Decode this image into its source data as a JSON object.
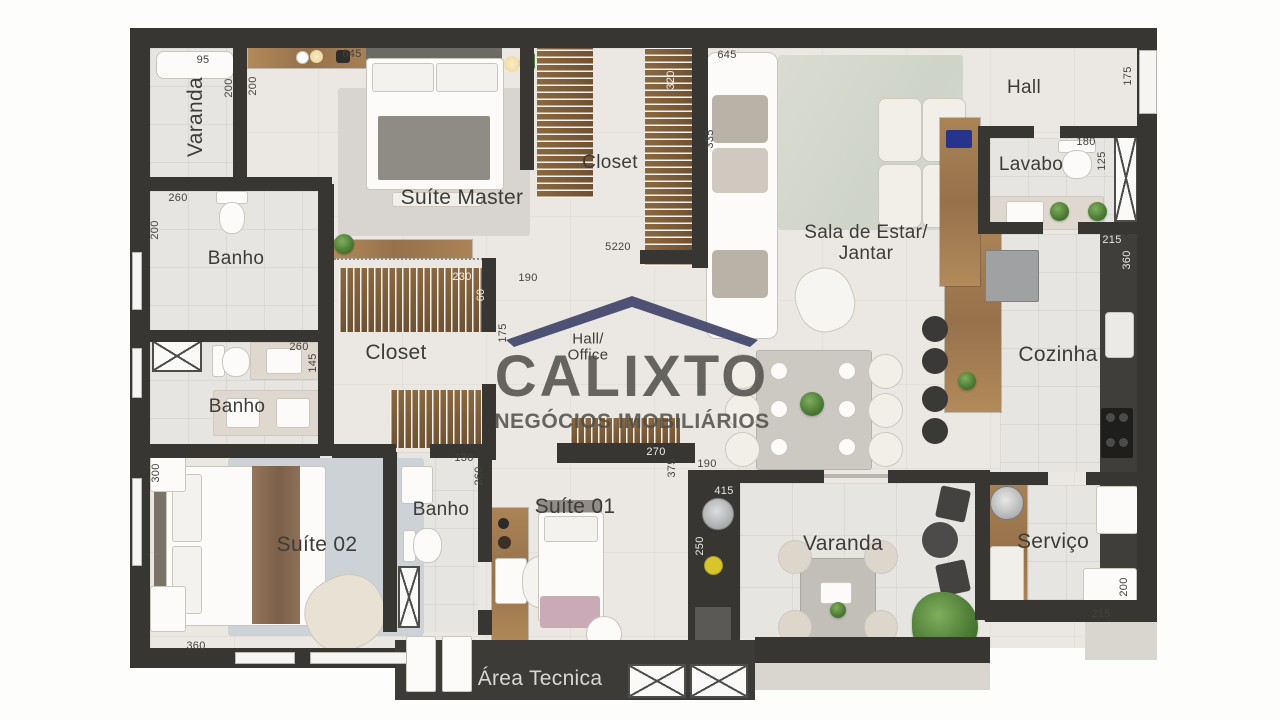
{
  "watermark": {
    "brand": "CALIXTO",
    "tagline": "NEGÓCIOS IMOBILIÁRIOS",
    "roof_color": "#3d4066",
    "text_color": "#4e4c46"
  },
  "colors": {
    "wall": "#383633",
    "floor": "#ebe8e3",
    "wood": "#a07a4e"
  },
  "rooms": {
    "varanda_top": "Varanda",
    "suite_master": "Suíte Master",
    "closet_top": "Closet",
    "hall": "Hall",
    "lavabo": "Lavabo",
    "sala_line1": "Sala de Estar/",
    "sala_line2": "Jantar",
    "banho_upper": "Banho",
    "banho_lower": "Banho",
    "closet_mid": "Closet",
    "hall_office_line1": "Hall/",
    "hall_office_line2": "Office",
    "cozinha": "Cozinha",
    "suite_02": "Suíte 02",
    "banho_suite01": "Banho",
    "suite_01": "Suíte 01",
    "varanda_bottom": "Varanda",
    "servico": "Serviço",
    "area_tecnica": "Área Tecnica"
  },
  "dims": {
    "varanda_top_w": "95",
    "varanda_top_l": "200",
    "master_wall": "200",
    "master_top": "645",
    "banho_upper_w": "260",
    "banho_upper_h": "200",
    "banho_lower_w": "260",
    "banho_lower_h": "145",
    "closet_top_l": "320",
    "sofa_l": "645",
    "sofa_d": "335",
    "closet_bottom": "5220",
    "closet_mid_w": "230",
    "closet_mid_d": "60",
    "hall_office_w": "190",
    "hall_office_h": "175",
    "entrance_h": "175",
    "lavabo_w": "180",
    "lavabo_h": "125",
    "cozinha_w": "215",
    "cozinha_h": "360",
    "suite02_h": "300",
    "suite02_w": "360",
    "banho3_w": "130",
    "banho3_h": "260",
    "suite01_w": "270",
    "suite01_h": "375",
    "varanda_b_w": "190",
    "varanda_b_top": "415",
    "varanda_b_h": "250",
    "servico_w": "215",
    "servico_h": "200"
  }
}
